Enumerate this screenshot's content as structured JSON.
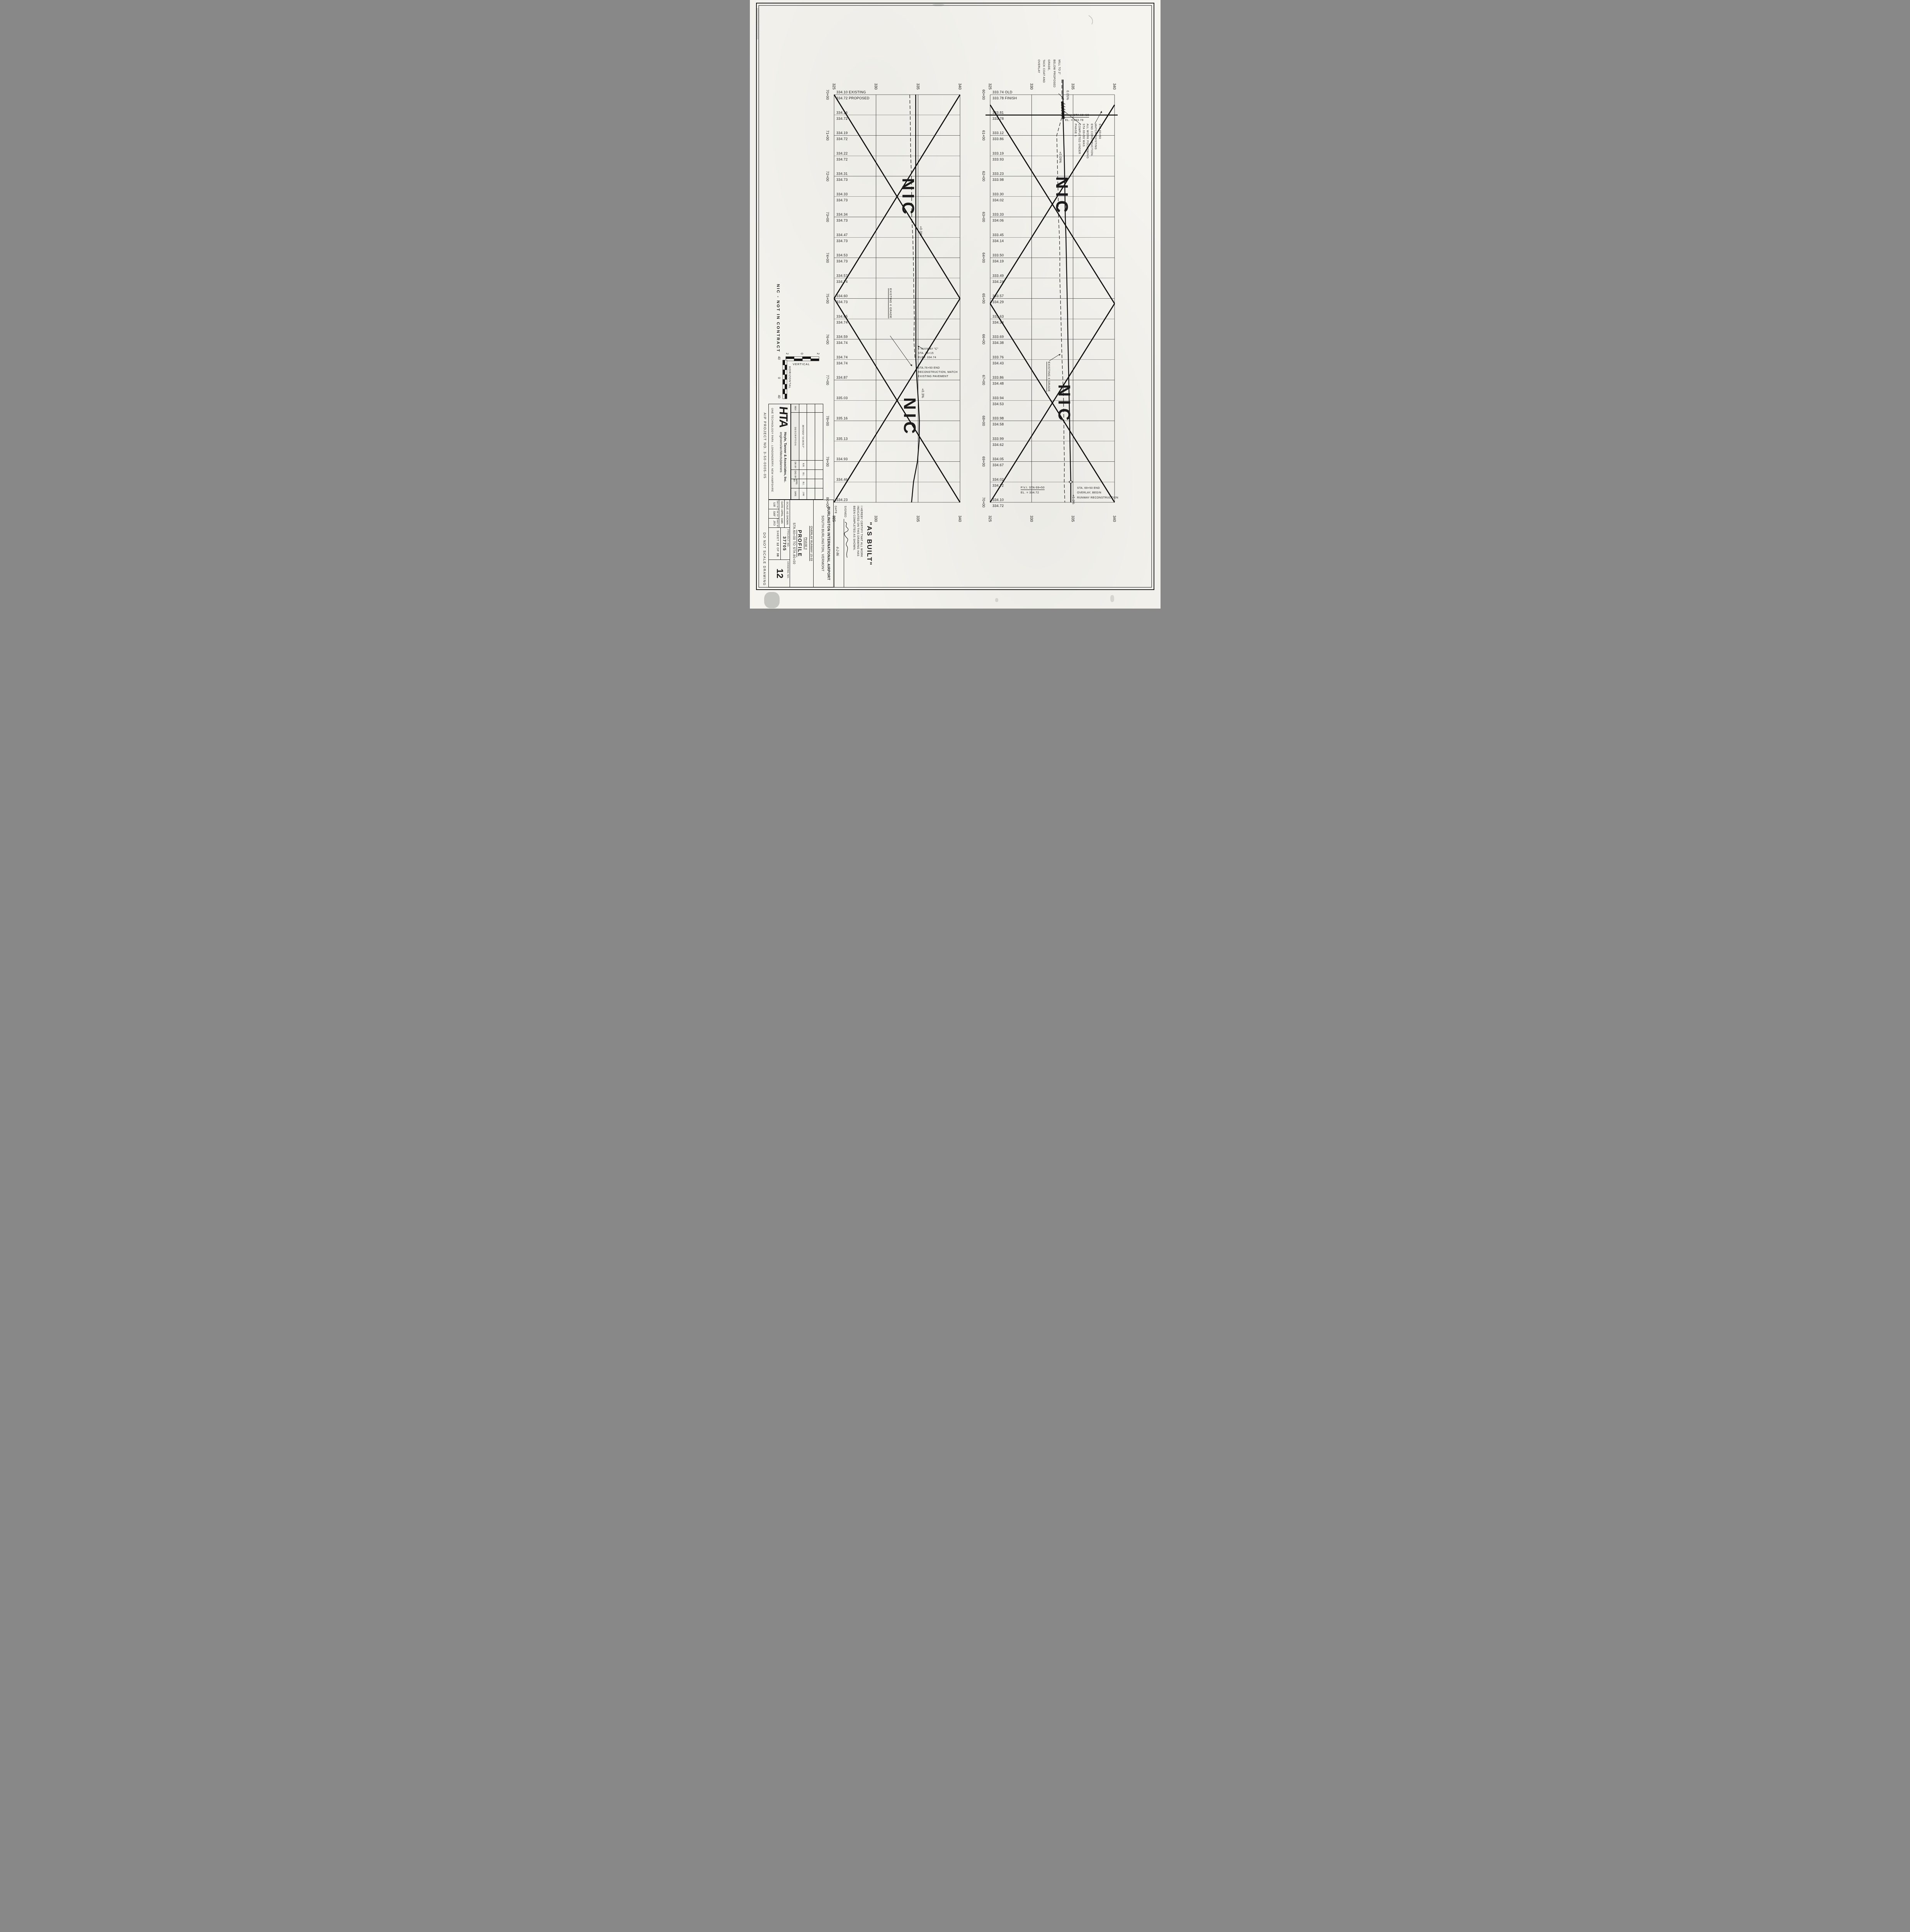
{
  "sheet": {
    "title_block": {
      "airport_line1": "BURLINGTON  INTERNATIONAL  AIRPORT",
      "airport_line2": "SOUTH  BURLINGTON,  VERMONT",
      "program": "OVERLAY  RUNWAY  15-33",
      "phase": "PHASE  II",
      "sheet_title": "PROFILE",
      "sheet_subtitle": "STA.60+00  TO  STA.80+00",
      "scale_label": "SCALE:",
      "scale_value": "AS SHOWN",
      "date_label": "DATE:",
      "date_value": "APRIL, 1985",
      "des_by_label": "DES. BY",
      "des_by": "SJR",
      "dr_by_label": "DR. BY",
      "dr_by": "SMF",
      "chkd_by_label": "CHKD. BY",
      "chkd_by": "JPD",
      "project_no_label": "PROJECT  NO.",
      "project_no": "37705",
      "sheet_label": "SHEET",
      "sheet_no": "12",
      "of_label": "OF",
      "sheet_total": "38",
      "drawing_no_label": "DRAWING  NO.",
      "drawing_no": "12"
    },
    "firm": {
      "logo": "HTA",
      "name": "Hoyle, Tanner & Associates, Inc.",
      "tagline": "engineers/architects/planners",
      "address": "ONE TECHNOLOGY PARK - LONDONDERRY, NEW HAMPSHIRE"
    },
    "revision_table": {
      "headers": {
        "rev": "REV",
        "description": "DESCRIPTION",
        "dr_by": "DR. BY",
        "ckd_by": "CKD. BY",
        "appd_by": "APPD. BY",
        "date": "DATE"
      },
      "rows": [
        {
          "rev": "",
          "description": "REVISED \"AS BUILT\"",
          "dr_by": "R.B.",
          "ckd_by": "B.L.",
          "appd_by": "B.L.",
          "date": "2/86"
        }
      ]
    },
    "as_built": {
      "heading": "\"AS BUILT\"",
      "certificate": "I HEREBY CERTIFY THAT ALL WORK\nINDICATED ON THIS DRAWING HAS\nBEEN COMPLETED AS SHOWN.",
      "signed_label": "SIGNED",
      "date_label": "DATE",
      "signature_date": "4-2-86"
    },
    "margin_notes": {
      "aip": "AIP PROJECT NO. 3-50-0005-05",
      "do_not_scale": "DO NOT SCALE DRAWING"
    },
    "legend": {
      "nic": "NIC - NOT IN CONTRACT",
      "horizontal_label": "HORIZONTAL",
      "vertical_label": "VERTICAL",
      "h_ticks": [
        "40",
        "0",
        "40"
      ],
      "v_ticks": [
        "2",
        "0",
        "2"
      ]
    }
  },
  "chart_data": [
    {
      "type": "line",
      "title": "Runway 15-33 as-built profile, STA 60+00 to STA 70+00",
      "xlabel": "station",
      "ylabel": "elevation (ft)",
      "ylim": [
        325,
        340
      ],
      "elev_ticks": [
        "325",
        "330",
        "335",
        "340"
      ],
      "grid": true,
      "stations": [
        "60+00",
        "60+50",
        "61+00",
        "61+50",
        "62+00",
        "62+50",
        "63+00",
        "63+50",
        "64+00",
        "64+50",
        "65+00",
        "65+50",
        "66+00",
        "66+50",
        "67+00",
        "67+50",
        "68+00",
        "68+50",
        "69+00",
        "69+50",
        "70+00"
      ],
      "series": [
        {
          "name": "existing (old) grade",
          "style": "dashed",
          "values": [
            "333.74",
            "333.81",
            "333.12",
            "333.19",
            "333.23",
            "333.30",
            "333.33",
            "333.45",
            "333.50",
            "333.49",
            "333.57",
            "333.63",
            "333.69",
            "333.76",
            "333.86",
            "333.94",
            "333.98",
            "333.99",
            "334.05",
            "334.02",
            "334.10"
          ]
        },
        {
          "name": "proposed (finish) grade",
          "style": "solid",
          "values": [
            "333.78",
            "333.78",
            "333.86",
            "333.93",
            "333.98",
            "334.02",
            "334.06",
            "334.14",
            "334.19",
            "334.24",
            "334.29",
            "334.34",
            "334.38",
            "334.43",
            "334.48",
            "334.53",
            "334.58",
            "334.62",
            "334.67",
            "334.72",
            "334.72"
          ]
        }
      ],
      "suffixes": {
        "0": [
          "OLD",
          "FINISH"
        ]
      },
      "nic": "NIC",
      "slope_labels": [
        "0.05%",
        "+0.09%",
        "+0.0%"
      ],
      "notes": {
        "mill": "MILL TO 2\"\nBELOW PROPOSED\nGRADE,\nTACK COAT AND\nOVERLAY",
        "pvi1_line1": "P.V.I. STA 60+50",
        "pvi1_line2": "EL. = 333.78",
        "match": "STA 60+50\nMATCH EXISTING\nEND CONSTRUCTION.\nALL WORK FOLLOWING\nSTA 60+50 WAS\nCOMPLETED UNDER\nPHASE 1.",
        "existing_grade": "EXISTING ¢ GRADE",
        "pvi2_line1": "P.V.I. STA 69+50",
        "pvi2_line2": "EL. = 334.72",
        "end_overlay": "STA. 69+50 END\nOVERLAY, BEGIN\nRUNWAY RECONSTRUCTION"
      }
    },
    {
      "type": "line",
      "title": "Runway 15-33 as-built profile, STA 70+00 to STA 80+00",
      "xlabel": "station",
      "ylabel": "elevation (ft)",
      "ylim": [
        325,
        340
      ],
      "elev_ticks": [
        "325",
        "330",
        "335",
        "340"
      ],
      "grid": true,
      "stations": [
        "70+00",
        "70+50",
        "71+00",
        "71+50",
        "72+00",
        "72+50",
        "73+00",
        "73+50",
        "74+00",
        "74+50",
        "75+00",
        "75+50",
        "76+00",
        "76+50",
        "77+00",
        "77+50",
        "78+00",
        "78+50",
        "79+00",
        "79+50",
        "80+00"
      ],
      "series": [
        {
          "name": "existing grade",
          "style": "dashed",
          "values": [
            "334.10",
            "334.16",
            "334.19",
            "334.22",
            "334.31",
            "334.33",
            "334.34",
            "334.47",
            "334.53",
            "334.57",
            "334.60",
            "334.65",
            "334.59",
            "334.74",
            "334.87",
            "335.03",
            "335.16",
            "335.13",
            "334.93",
            "334.46",
            "334.23"
          ]
        },
        {
          "name": "proposed grade",
          "style": "solid",
          "values": [
            "334.72",
            "334.72",
            "334.72",
            "334.72",
            "334.73",
            "334.73",
            "334.73",
            "334.73",
            "334.73",
            "334.74",
            "334.73",
            "334.74",
            "334.74",
            "334.74",
            null,
            null,
            null,
            null,
            null,
            null,
            null
          ]
        }
      ],
      "suffixes": {
        "0": [
          "EXISTING",
          "PROPOSED"
        ]
      },
      "nic": "NIC",
      "slope_labels": [
        "+0.0%",
        "+0.3%"
      ],
      "notes": {
        "existing_grade": "EXISTING ¢ GRADE",
        "taxiway": "¢ TAXIWAY \"C\"\nSTA. 76+15\nELEV. 334.74",
        "end_reconstruction": "STA.76+50 END\nRECONSTRUCTION, MATCH\nEXISTING PAVEMENT"
      }
    }
  ]
}
